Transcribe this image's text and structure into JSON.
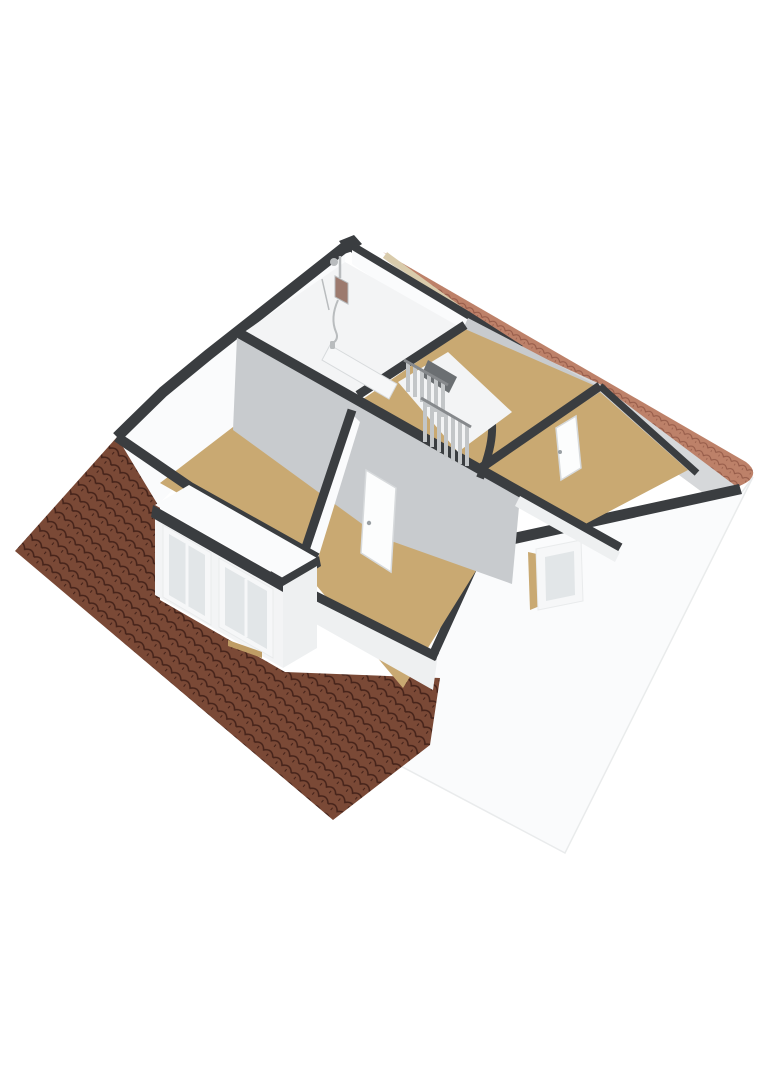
{
  "meta": {
    "description": "3D isometric cutaway floor plan render of an attic storey, viewed from above at an angle. No text labels are present in the image.",
    "view": "axonometric-top",
    "storey": "attic / first floor cutaway"
  },
  "colors": {
    "background": "#ffffff",
    "cap": "#3a3d40",
    "cap_soft": "#45484b",
    "wall_white": "#fafbfc",
    "wall_white_shaded": "#eef0f1",
    "wall_gray": "#c8cbce",
    "wall_gray_light": "#d6d8da",
    "floor_tan": "#c9a972",
    "floor_tan_deep": "#bf9d65",
    "floor_light": "#f3f4f5",
    "roof_dark_base": "#7a4936",
    "roof_dark_line": "#45231a",
    "roof_light_base": "#bd8169",
    "roof_light_line": "#935947",
    "fascia": "#d9cbab",
    "glass": "#e2e6e8",
    "frame_white": "#f6f7f8",
    "gable_edge": "#e9ebec",
    "stair_slat": "#c3c6c8",
    "stair_slat_dark": "#86898c",
    "stair_well_shadow": "#6b6f72",
    "fixture_metal": "#b9bcbe",
    "fixture_panel": "#9c7a6e",
    "door_leaf": "#fcfdfd",
    "door_edge": "#d7dadc",
    "door_handle": "#9aa0a4"
  },
  "scene": {
    "rooms": [
      {
        "id": "bathroom",
        "position": "top-left",
        "floor": "light",
        "features": [
          "shower-fixture",
          "sliding-door"
        ]
      },
      {
        "id": "landing",
        "position": "center",
        "floor": "tan",
        "features": [
          "open-staircase",
          "stairwell-opening"
        ]
      },
      {
        "id": "bedroom-left",
        "position": "left",
        "floor": "tan",
        "features": [
          "dormer-with-two-windows"
        ]
      },
      {
        "id": "bedroom-back",
        "position": "bottom-center",
        "floor": "tan",
        "features": [
          "door-to-landing"
        ]
      },
      {
        "id": "bedroom-right",
        "position": "right",
        "floor": "tan",
        "features": [
          "door-to-landing",
          "gable-window"
        ]
      }
    ],
    "roofs": [
      {
        "id": "roof-front",
        "slope": "south-west",
        "tiles": "dark-brown",
        "pattern": "scalloped-pan-tiles"
      },
      {
        "id": "roof-back",
        "slope": "north-east",
        "tiles": "terracotta",
        "pattern": "scalloped-pan-tiles",
        "detail": "flared eave at right end"
      }
    ],
    "windows": {
      "dormer_window_count": 2,
      "dormer_panes_per_window": 2,
      "gable_window_count": 1
    },
    "doors": {
      "interior_door_count": 2,
      "sliding_door_count": 1
    },
    "stairs": {
      "type": "open-riser",
      "balustrade": "vertical-slats"
    }
  }
}
